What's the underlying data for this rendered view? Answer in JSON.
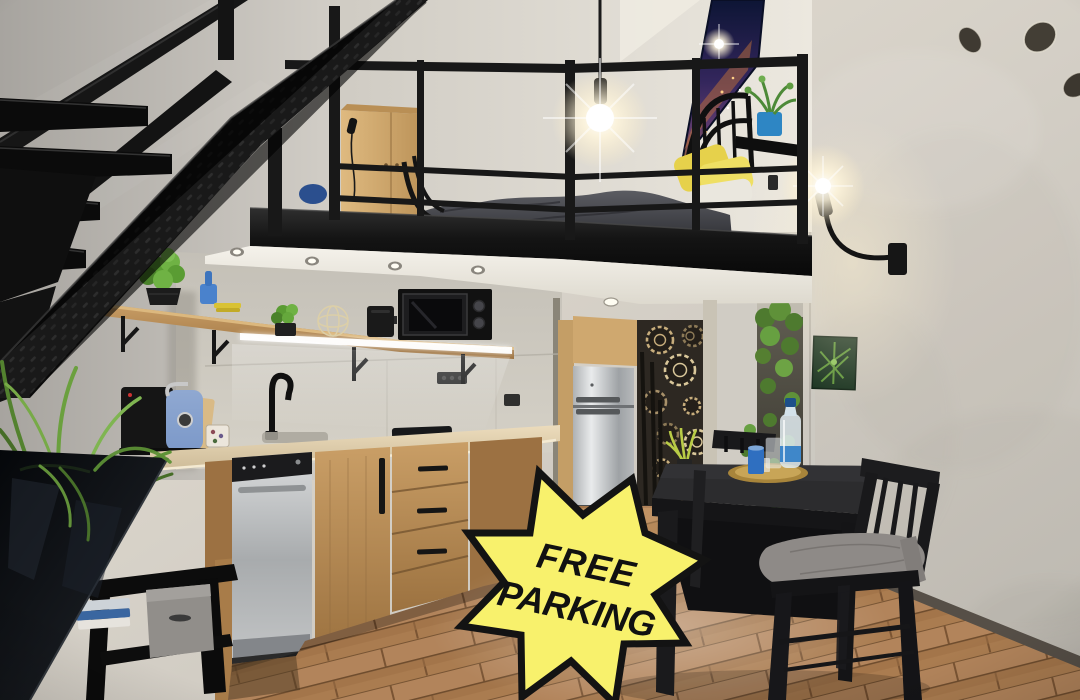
{
  "photo": {
    "alt": "Industrial loft studio apartment: black steel staircase and mezzanine bedroom with yellow pillows above a wooden kitchen, stainless refrigerator beside gear-pattern wallpaper, black dining table with two chairs, wall lamp on concrete wall and wooden plank floor"
  },
  "badge": {
    "line1": "FREE",
    "line2": "PARKING",
    "fill_color": "#f8f16c",
    "border_color": "#131313",
    "text_color": "#111111"
  },
  "palette": {
    "wall_concrete": "#cdc9c2",
    "metal_black": "#161616",
    "cabinet_wood": "#b5874f",
    "floor_wood": "#a97a4e",
    "steel": "#bfc2c4",
    "plant_green": "#6ba33e",
    "pillow_yellow": "#e9d854",
    "accent_blue": "#3f7fc4",
    "tray_gold": "#b8953f"
  }
}
